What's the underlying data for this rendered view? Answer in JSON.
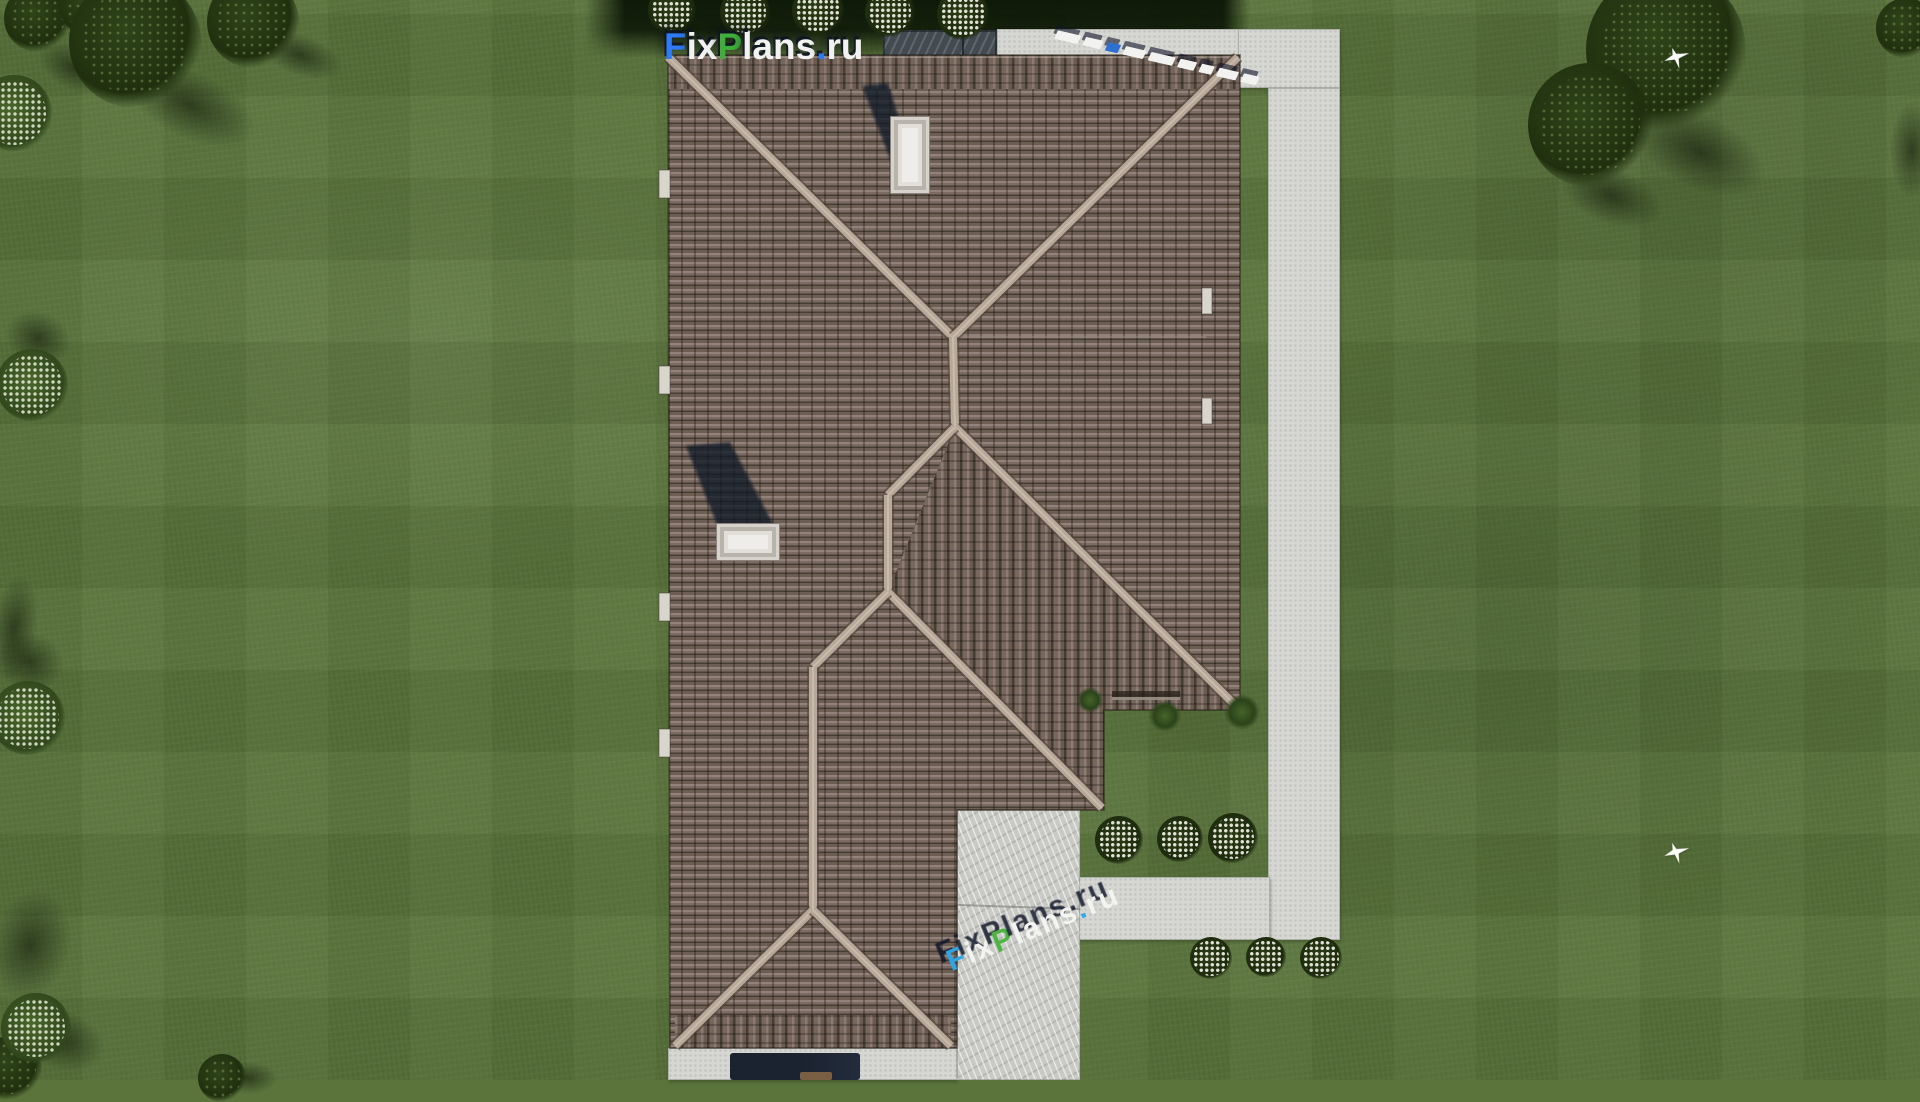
{
  "scene": {
    "description": "aerial top-down 3D render of a house hip roof with lawn, concrete walkway, driveway, trees and flowering bushes"
  },
  "watermarks": {
    "logo": {
      "full_text": "FixPlans.ru",
      "parts": [
        {
          "t": "F",
          "c": "#2e7bf6"
        },
        {
          "t": "ix",
          "c": "#f2f2f2"
        },
        {
          "t": "P",
          "c": "#3fae3a"
        },
        {
          "t": "lans",
          "c": "#f2f2f2"
        },
        {
          "t": ".",
          "c": "#2e7bf6"
        },
        {
          "t": "ru",
          "c": "#f2f2f2"
        }
      ]
    },
    "driveway_mark": {
      "full_text": "FixPlans.ru",
      "parts": [
        {
          "t": "F",
          "c": "#2ea8e8"
        },
        {
          "t": "ix",
          "c": "#f5f5f2"
        },
        {
          "t": "P",
          "c": "#49b43c"
        },
        {
          "t": "lans",
          "c": "#f5f5f2"
        },
        {
          "t": ".",
          "c": "#2ea8e8"
        },
        {
          "t": "ru",
          "c": "#f5f5f2"
        }
      ]
    },
    "path_corner_mark": {
      "block_widths": [
        24,
        18,
        13,
        21,
        25,
        17,
        13,
        20,
        16
      ],
      "blue_index": 2,
      "blue_color": "#2e6fd0"
    }
  },
  "colors": {
    "grass_base": "#5a743c",
    "hedge_shadow": "#10200a",
    "path": "#d6d7d3",
    "driveway": "#c9cac5",
    "patio": "#434b52",
    "roof_light": "#93827b",
    "roof_dark": "#463d34",
    "ridge_cap": "#b7a899",
    "chimney": "#efedea",
    "shadow_navy": "rgba(16,22,38,0.78)",
    "flower_white": "#f4f4ec",
    "tree_dark": "#20300f"
  },
  "topshade": {
    "x": 585,
    "y": 0,
    "w": 665,
    "h": 58
  },
  "paths": {
    "top": {
      "x": 997,
      "y": 29,
      "w": 245,
      "h": 29
    },
    "corner": {
      "x": 1238,
      "y": 29,
      "w": 102,
      "h": 59
    },
    "vertical": {
      "x": 1268,
      "y": 88,
      "w": 72,
      "h": 852
    },
    "bottom": {
      "x": 1078,
      "y": 877,
      "w": 192,
      "h": 63
    },
    "bottom_strip": {
      "x": 668,
      "y": 1048,
      "w": 289,
      "h": 32
    },
    "driveway": {
      "x": 957,
      "y": 810,
      "w": 123,
      "h": 270
    },
    "patio": {
      "x": 883,
      "y": 30,
      "w": 114,
      "h": 28
    },
    "porch_dark": {
      "x": 730,
      "y": 1053,
      "w": 130,
      "h": 27
    },
    "porch_detail": {
      "x": 800,
      "y": 1072,
      "w": 32,
      "h": 8
    }
  },
  "house": {
    "roof_outline_abs": "668,55 1240,55 1240,710 1104,710 1104,810 957,810 957,1048 670,1048",
    "ridges": [
      [
        668,
        57,
        953,
        337
      ],
      [
        1238,
        57,
        953,
        337
      ],
      [
        953,
        337,
        955,
        427
      ],
      [
        955,
        427,
        1238,
        708
      ],
      [
        955,
        427,
        888,
        495
      ],
      [
        888,
        495,
        888,
        592
      ],
      [
        888,
        592,
        1102,
        808
      ],
      [
        888,
        592,
        813,
        667
      ],
      [
        813,
        667,
        813,
        910
      ],
      [
        813,
        910,
        675,
        1046
      ],
      [
        813,
        910,
        951,
        1046
      ]
    ],
    "seam": [
      955,
      337,
      1206,
      337
    ],
    "fascia": [
      668,
      57,
      1238,
      57
    ],
    "chimneys": [
      {
        "x": 890,
        "y": 116,
        "w": 38,
        "h": 76
      },
      {
        "x": 716,
        "y": 523,
        "w": 62,
        "h": 36
      }
    ],
    "chimney_shadows": [
      "862,86 888,83 906,142 893,166",
      "686,446 730,442 774,526 718,527"
    ],
    "notches": [
      [
        659,
        170,
        11,
        28
      ],
      [
        659,
        366,
        11,
        28
      ],
      [
        659,
        593,
        11,
        28
      ],
      [
        659,
        729,
        11,
        28
      ],
      [
        1202,
        288,
        10,
        26
      ],
      [
        1202,
        398,
        10,
        26
      ]
    ],
    "groove": [
      1112,
      691,
      68,
      9
    ]
  },
  "landscape": {
    "trees": [
      [
        38,
        18,
        34
      ],
      [
        88,
        8,
        28
      ],
      [
        135,
        42,
        66
      ],
      [
        253,
        22,
        46
      ],
      [
        1666,
        50,
        80
      ],
      [
        1590,
        125,
        62
      ],
      [
        1906,
        28,
        30
      ],
      [
        10,
        1068,
        32
      ],
      [
        222,
        1078,
        24
      ]
    ],
    "shades": [
      [
        190,
        105,
        95,
        45,
        25
      ],
      [
        300,
        55,
        60,
        28,
        20
      ],
      [
        75,
        68,
        52,
        30,
        25
      ],
      [
        1700,
        152,
        95,
        50,
        25
      ],
      [
        1612,
        196,
        72,
        38,
        20
      ],
      [
        1912,
        150,
        30,
        65,
        0
      ],
      [
        14,
        628,
        32,
        72,
        8
      ],
      [
        38,
        338,
        46,
        36,
        20
      ],
      [
        30,
        662,
        46,
        40,
        15
      ],
      [
        30,
        945,
        55,
        75,
        15
      ],
      [
        62,
        1040,
        60,
        40,
        20
      ],
      [
        248,
        1078,
        40,
        22,
        0
      ]
    ],
    "bushes_white": [
      [
        672,
        10,
        24
      ],
      [
        745,
        12,
        25
      ],
      [
        818,
        10,
        26
      ],
      [
        890,
        12,
        25
      ],
      [
        963,
        14,
        26
      ],
      [
        1119,
        840,
        24
      ],
      [
        1180,
        839,
        23
      ],
      [
        1233,
        838,
        25
      ],
      [
        1211,
        958,
        21
      ],
      [
        1266,
        957,
        20
      ],
      [
        1321,
        958,
        21
      ]
    ],
    "bushes_light": [
      [
        14,
        113,
        38
      ],
      [
        32,
        385,
        36
      ],
      [
        28,
        718,
        37
      ],
      [
        36,
        1028,
        35
      ]
    ],
    "tufts": [
      [
        1090,
        700,
        13
      ],
      [
        1165,
        716,
        16
      ],
      [
        1242,
        712,
        18
      ]
    ],
    "birds": [
      [
        1677,
        58
      ],
      [
        1677,
        853
      ]
    ]
  }
}
